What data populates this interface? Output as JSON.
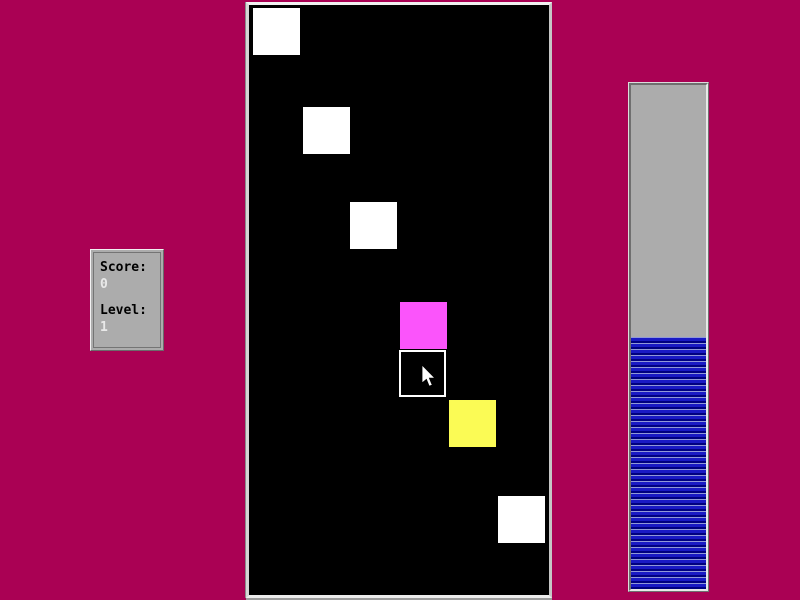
{
  "theme": {
    "background_color": "#AA0154",
    "panel_gray": "#ACACAC",
    "playfield_background": "#000000"
  },
  "score_panel": {
    "score_label": "Score:",
    "score_value": "0",
    "level_label": "Level:",
    "level_value": "1"
  },
  "playfield": {
    "squares": [
      {
        "x": 4,
        "y": 3,
        "size": 47,
        "color": "#FFFFFF",
        "type": "solid"
      },
      {
        "x": 54,
        "y": 102,
        "size": 47,
        "color": "#FFFFFF",
        "type": "solid"
      },
      {
        "x": 101,
        "y": 197,
        "size": 47,
        "color": "#FFFFFF",
        "type": "solid"
      },
      {
        "x": 151,
        "y": 297,
        "size": 47,
        "color": "#FB54FB",
        "type": "solid"
      },
      {
        "x": 150,
        "y": 345,
        "size": 47,
        "color": "#FFFFFF",
        "type": "outlined"
      },
      {
        "x": 200,
        "y": 395,
        "size": 47,
        "color": "#FBFB55",
        "type": "solid"
      },
      {
        "x": 249,
        "y": 491,
        "size": 47,
        "color": "#FFFFFF",
        "type": "solid"
      }
    ],
    "cursor": {
      "x": 172,
      "y": 360
    }
  },
  "progress_bar": {
    "fill_percent": 50,
    "stripe_light": "#9098D8",
    "stripe_blue": "#1A1AC4",
    "stripe_dark": "#000080",
    "track_color": "#ACACAC"
  }
}
